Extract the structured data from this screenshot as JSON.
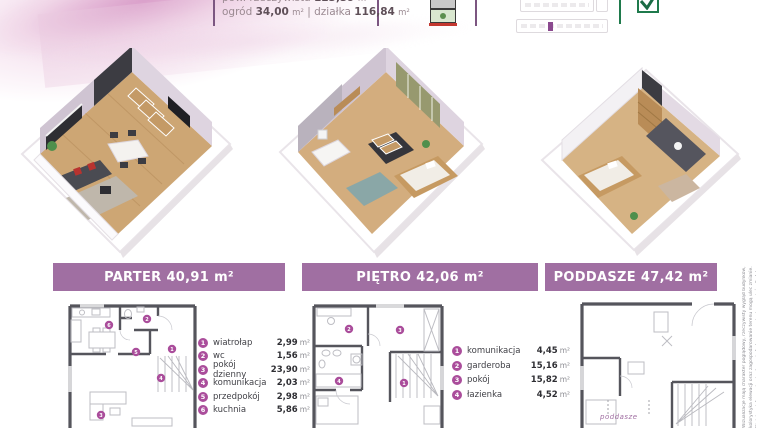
{
  "header": {
    "line1": {
      "label": "pow. rzeczywista",
      "value": "123,39",
      "unit": "m²"
    },
    "line2": {
      "garden_label": "ogród",
      "garden_value": "34,00",
      "garden_unit": "m²",
      "separator": "|",
      "plot_label": "działka",
      "plot_value": "116,84",
      "plot_unit": "m²"
    }
  },
  "header_icons": {
    "building_icon": "building-cross-section-icon",
    "scale_widget": "floor-scale-widget",
    "check_icon": "quality-check-icon"
  },
  "floors": [
    {
      "name": "PARTER",
      "area": "40,91",
      "unit": "m²"
    },
    {
      "name": "PIĘTRO",
      "area": "42,06",
      "unit": "m²"
    },
    {
      "name": "PODDASZE",
      "area": "47,42",
      "unit": "m²"
    }
  ],
  "legends": {
    "parter": {
      "items": [
        {
          "num": "1",
          "name": "wiatrołap",
          "area": "2,99",
          "unit": "m²"
        },
        {
          "num": "2",
          "name": "wc",
          "area": "1,56",
          "unit": "m²"
        },
        {
          "num": "3",
          "name": "pokój dzienny",
          "area": "23,90",
          "unit": "m²"
        },
        {
          "num": "4",
          "name": "komunikacja",
          "area": "2,03",
          "unit": "m²"
        },
        {
          "num": "5",
          "name": "przedpokój",
          "area": "2,98",
          "unit": "m²"
        },
        {
          "num": "6",
          "name": "kuchnia",
          "area": "5,86",
          "unit": "m²"
        }
      ]
    },
    "pietro": {
      "items": [
        {
          "num": "1",
          "name": "komunikacja",
          "area": "4,45",
          "unit": "m²"
        },
        {
          "num": "2",
          "name": "garderoba",
          "area": "15,16",
          "unit": "m²"
        },
        {
          "num": "3",
          "name": "pokój",
          "area": "15,82",
          "unit": "m²"
        },
        {
          "num": "4",
          "name": "łazienka",
          "area": "4,52",
          "unit": "m²"
        }
      ]
    }
  },
  "plan_labels": {
    "poddasze": "poddasze"
  },
  "disclaimer": "Wizualizacje mają charakter poglądowy, rzeczywisty wygląd budynków, kolorystyka elewacji oraz zagospodarowanie terenu mogą ulec zmianie. Niniejsza informacja nie stanowi oferty w rozumieniu przepisów Kodeksu cywilnego.",
  "colors": {
    "banner_purple": "#a06fa2",
    "badge_purple": "#aa4d9b",
    "check_green": "#1f7a4c",
    "wall_gray": "#55555c",
    "wood_floor": "#cda674"
  }
}
